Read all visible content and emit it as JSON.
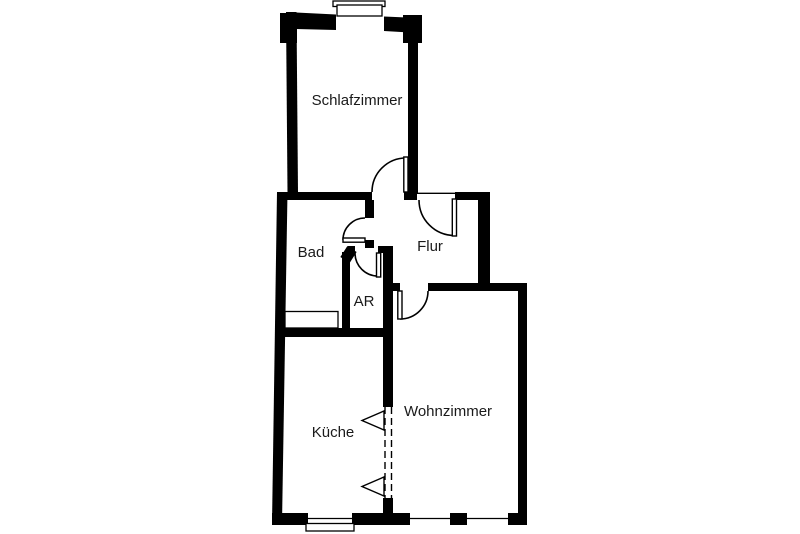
{
  "plan": {
    "background_color": "#ffffff",
    "wall_color": "#000000",
    "text_color": "#1a1a1a",
    "rooms": [
      {
        "id": "schlafzimmer",
        "label": "Schlafzimmer"
      },
      {
        "id": "bad",
        "label": "Bad"
      },
      {
        "id": "flur",
        "label": "Flur"
      },
      {
        "id": "ar",
        "label": "AR"
      },
      {
        "id": "kueche",
        "label": "Küche"
      },
      {
        "id": "wohnzimmer",
        "label": "Wohnzimmer"
      }
    ]
  }
}
